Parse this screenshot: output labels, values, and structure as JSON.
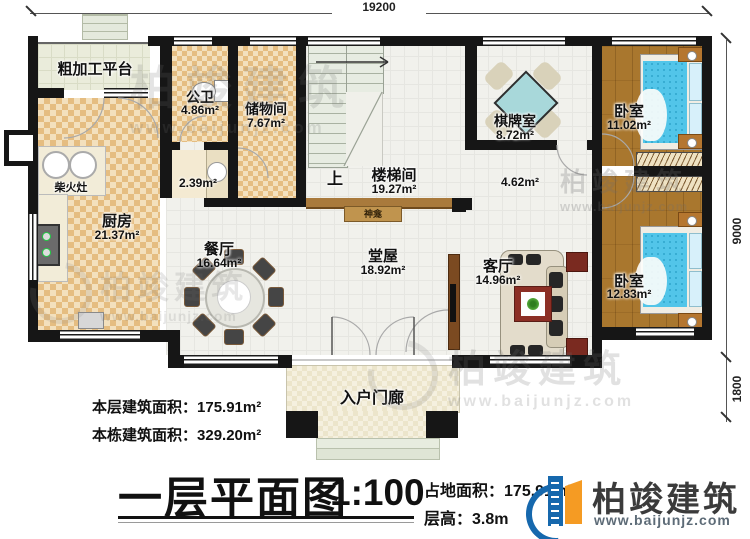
{
  "dimensions": {
    "top": "19200",
    "right_upper": "9000",
    "right_lower": "1800"
  },
  "rooms": {
    "platform": {
      "name": "粗加工平台"
    },
    "bath": {
      "name": "公卫",
      "area": "4.86m²"
    },
    "storage": {
      "name": "储物间",
      "area": "7.67m²"
    },
    "stove": {
      "name": "柴火灶"
    },
    "kitchen": {
      "name": "厨房",
      "area": "21.37m²"
    },
    "corridor": {
      "area": "2.39m²"
    },
    "stairwell": {
      "name": "楼梯间",
      "area": "19.27m²",
      "up": "上"
    },
    "shrine": {
      "name": "神龛"
    },
    "dining": {
      "name": "餐厅",
      "area": "16.64m²"
    },
    "hall": {
      "name": "堂屋",
      "area": "18.92m²"
    },
    "game": {
      "name": "棋牌室",
      "area": "8.72m²"
    },
    "hallway": {
      "area": "4.62m²"
    },
    "living": {
      "name": "客厅",
      "area": "14.96m²"
    },
    "bedroom1": {
      "name": "卧室",
      "area": "11.02m²"
    },
    "bedroom2": {
      "name": "卧室",
      "area": "12.83m²"
    },
    "porch": {
      "name": "入户门廊"
    }
  },
  "stats": {
    "floor_area_label": "本层建筑面积：",
    "floor_area_value": "175.91m²",
    "building_area_label": "本栋建筑面积：",
    "building_area_value": "329.20m²"
  },
  "titleblock": {
    "title": "一层平面图",
    "scale": "1:100",
    "site_area_label": "占地面积：",
    "site_area_value": "175.91m²",
    "floor_height_label": "层高：",
    "floor_height_value": "3.8m"
  },
  "brand": {
    "name": "柏竣建筑",
    "url": "www.baijunjz.com"
  },
  "watermark": {
    "name": "柏竣建筑",
    "url": "www.baijunjz.com"
  },
  "colors": {
    "accent_blue": "#1668ad",
    "accent_orange": "#f59b23",
    "wall": "#161616",
    "bed": "#52c5e9"
  }
}
